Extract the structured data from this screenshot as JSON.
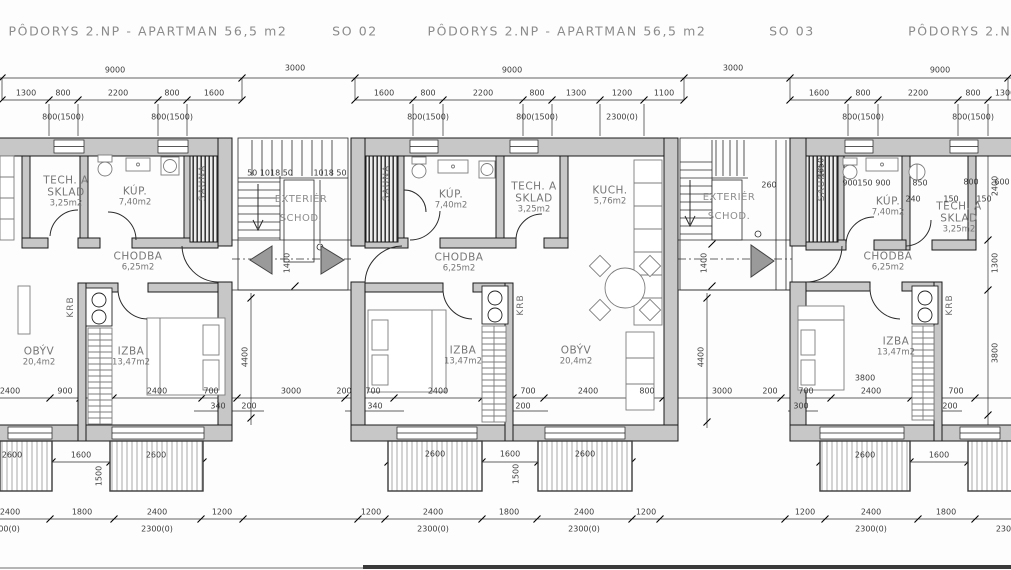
{
  "drawing": {
    "type": "floor-plan",
    "floor": "2.NP",
    "apartment_area": "56,5 m2"
  },
  "colors": {
    "wall_fill": "#c7c7c7",
    "line": "#1a1a1a",
    "label_gray": "#767676",
    "paper": "#fdfdfd"
  },
  "titles": [
    {
      "text": "PÔDORYS 2.NP - APARTMAN 56,5 m2",
      "x": 148,
      "y": 31
    },
    {
      "text": "SO 02",
      "x": 355,
      "y": 31
    },
    {
      "text": "PÔDORYS 2.NP - APARTMAN 56,5 m2",
      "x": 567,
      "y": 31
    },
    {
      "text": "SO 03",
      "x": 792,
      "y": 31
    },
    {
      "text": "PÔDORYS 2.NP - A",
      "x": 978,
      "y": 31
    }
  ],
  "rooms": [
    {
      "lines": [
        "TECH. A",
        "SKLAD",
        "3,25m2"
      ],
      "x": 66,
      "y": 192
    },
    {
      "lines": [
        "KÚP.",
        "7,40m2"
      ],
      "x": 135,
      "y": 197
    },
    {
      "lines": [
        "CHODBA",
        "6,25m2"
      ],
      "x": 138,
      "y": 262
    },
    {
      "lines": [
        "OBÝV",
        "20,4m2"
      ],
      "x": 39,
      "y": 357
    },
    {
      "lines": [
        "IZBA",
        "13,47m2"
      ],
      "x": 131,
      "y": 357
    },
    {
      "lines": [
        "KÚP.",
        "7,40m2"
      ],
      "x": 451,
      "y": 200
    },
    {
      "lines": [
        "TECH. A",
        "SKLAD",
        "3,25m2"
      ],
      "x": 534,
      "y": 198
    },
    {
      "lines": [
        "KUCH.",
        "5,76m2"
      ],
      "x": 610,
      "y": 196
    },
    {
      "lines": [
        "CHODBA",
        "6,25m2"
      ],
      "x": 459,
      "y": 263
    },
    {
      "lines": [
        "IZBA",
        "13,47m2"
      ],
      "x": 463,
      "y": 356
    },
    {
      "lines": [
        "OBÝV",
        "20,4m2"
      ],
      "x": 576,
      "y": 356
    },
    {
      "lines": [
        "KÚP.",
        "7,40m2"
      ],
      "x": 888,
      "y": 207
    },
    {
      "lines": [
        "TECH. A",
        "SKLAD",
        "3,25m2"
      ],
      "x": 959,
      "y": 218
    },
    {
      "lines": [
        "CHODBA",
        "6,25m2"
      ],
      "x": 888,
      "y": 262
    },
    {
      "lines": [
        "IZBA",
        "13,47m2"
      ],
      "x": 896,
      "y": 347
    }
  ],
  "stair_labels": [
    {
      "lines": [
        "EXTERIÉR",
        "SCHOD."
      ],
      "x": 301,
      "y": 209
    },
    {
      "lines": [
        "EXTERIÉR",
        "SCHOD."
      ],
      "x": 729,
      "y": 207
    }
  ],
  "vertical_labels": [
    {
      "t": "SAUNA",
      "x": 203,
      "y": 183
    },
    {
      "t": "SAUNA",
      "x": 387,
      "y": 183
    },
    {
      "t": "SAUNA",
      "x": 822,
      "y": 183
    },
    {
      "t": "KRB",
      "x": 71,
      "y": 307
    },
    {
      "t": "KRB",
      "x": 521,
      "y": 305
    },
    {
      "t": "KRB",
      "x": 950,
      "y": 305
    }
  ],
  "dimension_labels": [
    {
      "t": "9000",
      "x": 115,
      "y": 70
    },
    {
      "t": "3000",
      "x": 295,
      "y": 68
    },
    {
      "t": "9000",
      "x": 512,
      "y": 70
    },
    {
      "t": "3000",
      "x": 733,
      "y": 68
    },
    {
      "t": "9000",
      "x": 940,
      "y": 70
    },
    {
      "t": "1300",
      "x": 26,
      "y": 93
    },
    {
      "t": "800",
      "x": 63,
      "y": 93
    },
    {
      "t": "2200",
      "x": 118,
      "y": 93
    },
    {
      "t": "800",
      "x": 172,
      "y": 93
    },
    {
      "t": "1600",
      "x": 214,
      "y": 93
    },
    {
      "t": "1600",
      "x": 384,
      "y": 93
    },
    {
      "t": "800",
      "x": 428,
      "y": 93
    },
    {
      "t": "2200",
      "x": 483,
      "y": 93
    },
    {
      "t": "800",
      "x": 537,
      "y": 93
    },
    {
      "t": "1300",
      "x": 576,
      "y": 93
    },
    {
      "t": "1200",
      "x": 622,
      "y": 93
    },
    {
      "t": "1100",
      "x": 664,
      "y": 93
    },
    {
      "t": "1600",
      "x": 819,
      "y": 93
    },
    {
      "t": "800",
      "x": 863,
      "y": 93
    },
    {
      "t": "2200",
      "x": 918,
      "y": 93
    },
    {
      "t": "800",
      "x": 973,
      "y": 93
    },
    {
      "t": "1300",
      "x": 1005,
      "y": 93
    },
    {
      "t": "800(1500)",
      "x": 63,
      "y": 117
    },
    {
      "t": "800(1500)",
      "x": 172,
      "y": 117
    },
    {
      "t": "800(1500)",
      "x": 428,
      "y": 117
    },
    {
      "t": "800(1500)",
      "x": 537,
      "y": 117
    },
    {
      "t": "2300(0)",
      "x": 622,
      "y": 117
    },
    {
      "t": "800(1500)",
      "x": 863,
      "y": 117
    },
    {
      "t": "800(1500)",
      "x": 973,
      "y": 117
    },
    {
      "t": "50 1018 50",
      "x": 270,
      "y": 173
    },
    {
      "t": "1018 50",
      "x": 330,
      "y": 173
    },
    {
      "t": "260",
      "x": 769,
      "y": 185
    },
    {
      "t": "900",
      "x": 850,
      "y": 183
    },
    {
      "t": "150",
      "x": 865,
      "y": 183
    },
    {
      "t": "900",
      "x": 883,
      "y": 183
    },
    {
      "t": "850",
      "x": 920,
      "y": 183
    },
    {
      "t": "800",
      "x": 971,
      "y": 182
    },
    {
      "t": "600",
      "x": 1002,
      "y": 182
    },
    {
      "t": "240",
      "x": 913,
      "y": 199
    },
    {
      "t": "150",
      "x": 951,
      "y": 199
    },
    {
      "t": "150",
      "x": 984,
      "y": 199
    },
    {
      "t": "2400",
      "x": 10,
      "y": 391
    },
    {
      "t": "900",
      "x": 65,
      "y": 391
    },
    {
      "t": "2400",
      "x": 157,
      "y": 391
    },
    {
      "t": "700",
      "x": 211,
      "y": 391
    },
    {
      "t": "3000",
      "x": 291,
      "y": 391
    },
    {
      "t": "340",
      "x": 218,
      "y": 406
    },
    {
      "t": "200",
      "x": 249,
      "y": 406
    },
    {
      "t": "200",
      "x": 344,
      "y": 391
    },
    {
      "t": "700",
      "x": 373,
      "y": 391
    },
    {
      "t": "2400",
      "x": 438,
      "y": 391
    },
    {
      "t": "700",
      "x": 528,
      "y": 391
    },
    {
      "t": "2400",
      "x": 588,
      "y": 391
    },
    {
      "t": "800",
      "x": 647,
      "y": 391
    },
    {
      "t": "340",
      "x": 375,
      "y": 406
    },
    {
      "t": "200",
      "x": 523,
      "y": 406
    },
    {
      "t": "3000",
      "x": 722,
      "y": 391
    },
    {
      "t": "200",
      "x": 770,
      "y": 391
    },
    {
      "t": "700",
      "x": 806,
      "y": 391
    },
    {
      "t": "2400",
      "x": 871,
      "y": 391
    },
    {
      "t": "700",
      "x": 956,
      "y": 391
    },
    {
      "t": "3800",
      "x": 865,
      "y": 378
    },
    {
      "t": "300",
      "x": 801,
      "y": 406
    },
    {
      "t": "200",
      "x": 950,
      "y": 406
    },
    {
      "t": "2600",
      "x": 12,
      "y": 455
    },
    {
      "t": "1600",
      "x": 81,
      "y": 455
    },
    {
      "t": "2600",
      "x": 156,
      "y": 455
    },
    {
      "t": "2600",
      "x": 435,
      "y": 454
    },
    {
      "t": "1600",
      "x": 510,
      "y": 454
    },
    {
      "t": "2600",
      "x": 585,
      "y": 454
    },
    {
      "t": "2600",
      "x": 865,
      "y": 455
    },
    {
      "t": "1600",
      "x": 939,
      "y": 455
    },
    {
      "t": "2400",
      "x": 10,
      "y": 512
    },
    {
      "t": "1800",
      "x": 82,
      "y": 512
    },
    {
      "t": "2400",
      "x": 157,
      "y": 512
    },
    {
      "t": "1200",
      "x": 222,
      "y": 512
    },
    {
      "t": "1200",
      "x": 371,
      "y": 512
    },
    {
      "t": "2400",
      "x": 433,
      "y": 512
    },
    {
      "t": "1800",
      "x": 509,
      "y": 512
    },
    {
      "t": "2400",
      "x": 584,
      "y": 512
    },
    {
      "t": "1200",
      "x": 646,
      "y": 512
    },
    {
      "t": "1200",
      "x": 805,
      "y": 512
    },
    {
      "t": "2400",
      "x": 871,
      "y": 512
    },
    {
      "t": "1800",
      "x": 946,
      "y": 512
    },
    {
      "t": "2300(0)",
      "x": 4,
      "y": 529
    },
    {
      "t": "2300(0)",
      "x": 157,
      "y": 529
    },
    {
      "t": "2300(0)",
      "x": 433,
      "y": 529
    },
    {
      "t": "2300(0)",
      "x": 584,
      "y": 529
    },
    {
      "t": "2300(0)",
      "x": 871,
      "y": 529
    },
    {
      "t": "2300",
      "x": 1006,
      "y": 529
    },
    {
      "t": "1400",
      "x": 287,
      "y": 263,
      "r": 1
    },
    {
      "t": "1400",
      "x": 704,
      "y": 263,
      "r": 1
    },
    {
      "t": "4400",
      "x": 245,
      "y": 357,
      "r": 1
    },
    {
      "t": "4400",
      "x": 701,
      "y": 357,
      "r": 1
    },
    {
      "t": "1500",
      "x": 99,
      "y": 476,
      "r": 1
    },
    {
      "t": "1500",
      "x": 516,
      "y": 474,
      "r": 1
    },
    {
      "t": "1650",
      "x": 821,
      "y": 168,
      "r": 1
    },
    {
      "t": "2400",
      "x": 995,
      "y": 186,
      "r": 1
    },
    {
      "t": "1300",
      "x": 995,
      "y": 263,
      "r": 1
    },
    {
      "t": "3800",
      "x": 995,
      "y": 353,
      "r": 1
    }
  ]
}
